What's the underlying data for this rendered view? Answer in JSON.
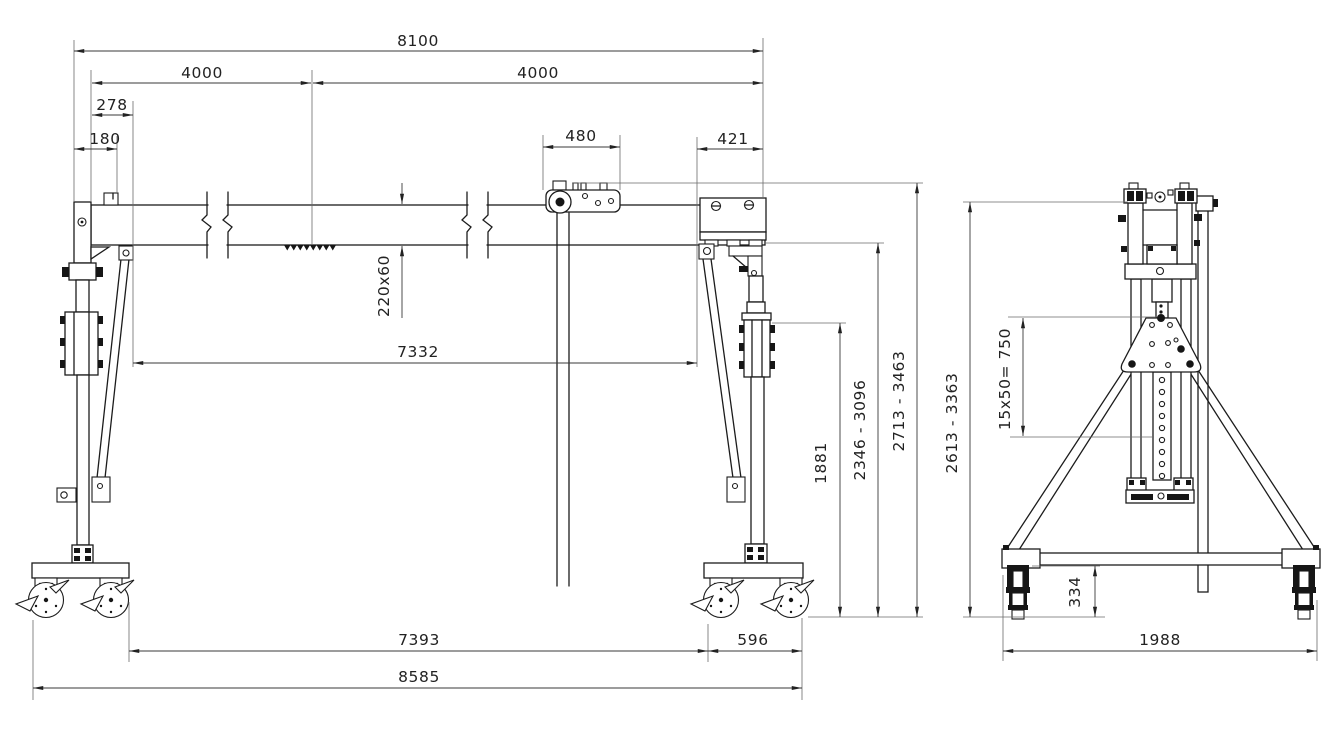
{
  "colors": {
    "ink": "#1c1c1c",
    "dim_line": "#3a3a3a",
    "background": "#ffffff"
  },
  "front_view": {
    "dims": {
      "overall_top": "8100",
      "span_half_left": "4000",
      "span_half_right": "4000",
      "brace_offset": "278",
      "endstop_offset": "180",
      "trolley_length": "480",
      "carriage_length": "421",
      "beam_profile": "220x60",
      "inner_span": "7332",
      "mast_clamp_height": "1881",
      "underbeam_height_range": "2346 - 3096",
      "overall_height_range": "2713 - 3463",
      "inner_wheel_span": "7393",
      "leg_wheel_spread": "596",
      "overall_bottom": "8585"
    }
  },
  "side_view": {
    "dims": {
      "height_range": "2613 - 3363",
      "hole_pattern": "15x50= 750",
      "caster_height": "334",
      "base_width": "1988"
    }
  }
}
